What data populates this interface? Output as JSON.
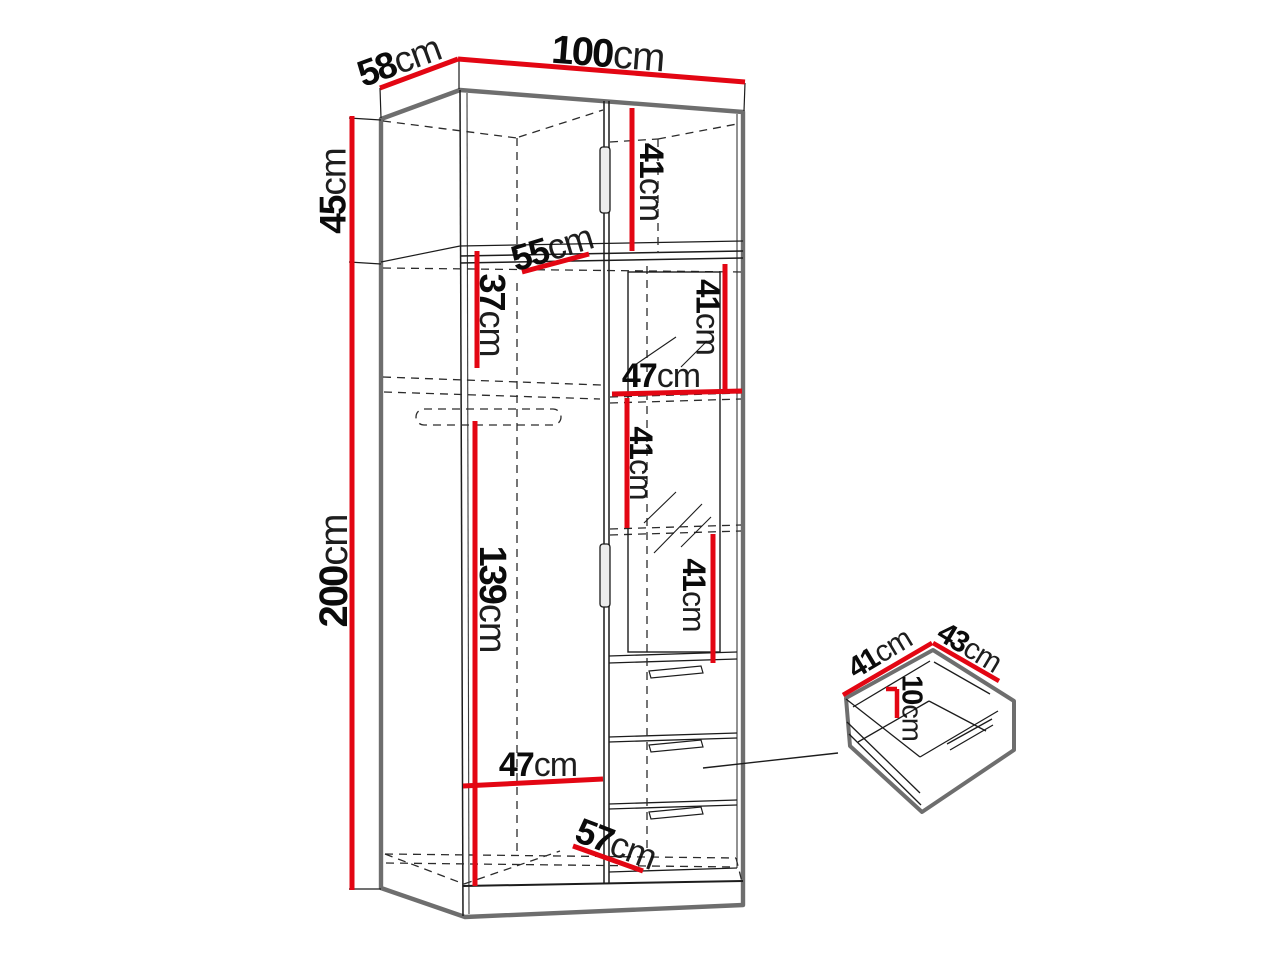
{
  "diagram": {
    "type": "furniture-dimension-diagram",
    "subject": "wardrobe with top cabinet, mirror door, three drawers and separate drawer detail",
    "colors": {
      "dimension_line_red": "#e30613",
      "silhouette_gray": "#6e6e6e",
      "line_black": "#1c1c1c",
      "background": "#ffffff"
    }
  },
  "labels": [
    {
      "name": "top-depth",
      "value": "58",
      "unit": "cm"
    },
    {
      "name": "top-width",
      "value": "100",
      "unit": "cm"
    },
    {
      "name": "upper-cabinet-height",
      "value": "45",
      "unit": "cm"
    },
    {
      "name": "main-body-height",
      "value": "200",
      "unit": "cm"
    },
    {
      "name": "upper-cabinet-inner-height",
      "value": "41",
      "unit": "cm"
    },
    {
      "name": "inner-depth-top",
      "value": "55",
      "unit": "cm"
    },
    {
      "name": "shelf-space-height",
      "value": "37",
      "unit": "cm"
    },
    {
      "name": "right-top-shelf-height",
      "value": "41",
      "unit": "cm"
    },
    {
      "name": "right-inner-width",
      "value": "47",
      "unit": "cm"
    },
    {
      "name": "right-mid-shelf-height",
      "value": "41",
      "unit": "cm"
    },
    {
      "name": "right-lower-shelf-height",
      "value": "41",
      "unit": "cm"
    },
    {
      "name": "hanging-space-height",
      "value": "139",
      "unit": "cm"
    },
    {
      "name": "left-inner-width",
      "value": "47",
      "unit": "cm"
    },
    {
      "name": "inner-depth-bottom",
      "value": "57",
      "unit": "cm"
    },
    {
      "name": "drawer-depth",
      "value": "41",
      "unit": "cm"
    },
    {
      "name": "drawer-width",
      "value": "43",
      "unit": "cm"
    },
    {
      "name": "drawer-height",
      "value": "10",
      "unit": "cm"
    }
  ]
}
